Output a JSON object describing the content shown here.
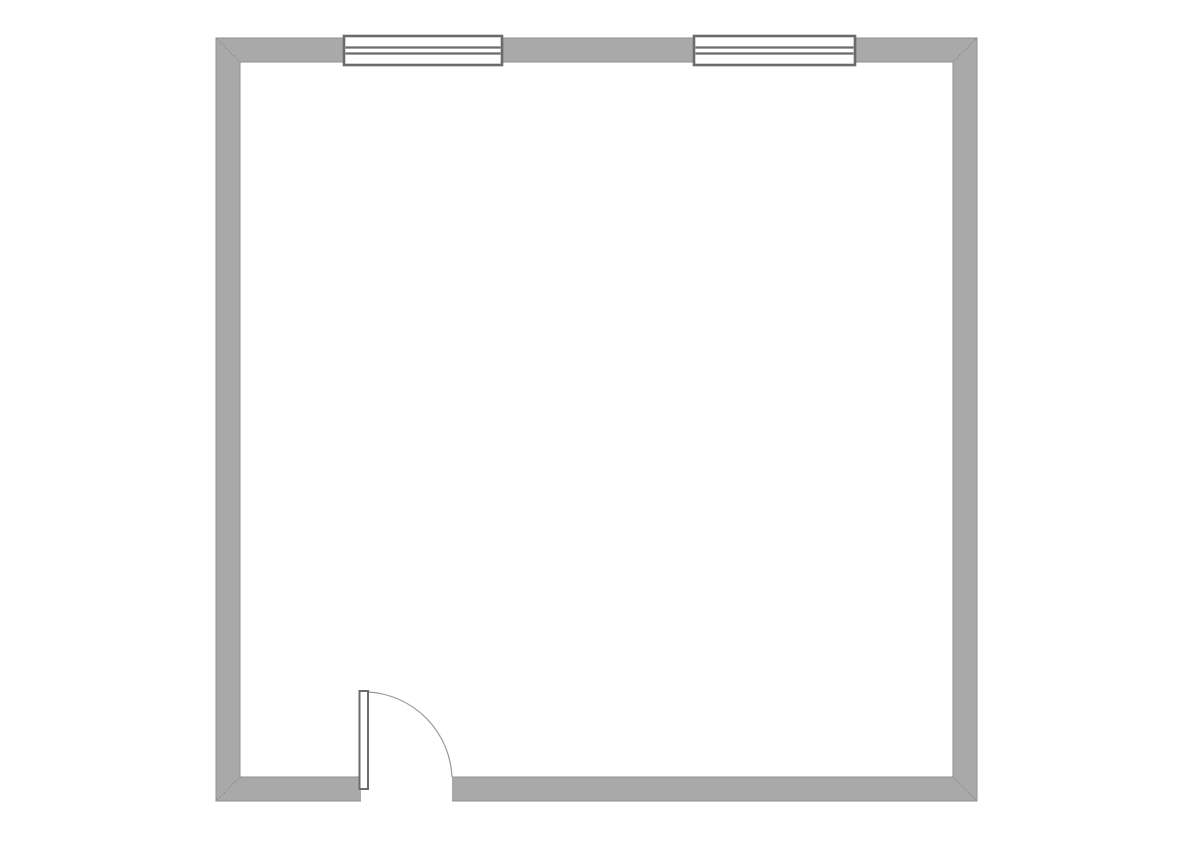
{
  "document": {
    "type": "architectural-floor-plan",
    "canvas": {
      "width": 1190,
      "height": 841,
      "background": "#ffffff"
    }
  },
  "palette": {
    "wall_fill": "#a9a9a9",
    "wall_edge": "#8f8f8f",
    "symbol_stroke": "#6b6b6b",
    "miter_line": "#8a8a8a",
    "swing_arc": "#9a9a9a",
    "opening_fill": "#ffffff"
  },
  "room": {
    "outer": {
      "x": 216,
      "y": 38,
      "width": 761,
      "height": 763
    },
    "wall_thickness": 24,
    "corner_miters": [
      "top-left",
      "top-right",
      "bottom-left",
      "bottom-right"
    ]
  },
  "windows": [
    {
      "id": "window-1",
      "wall": "top",
      "x": 344,
      "y": 36,
      "width": 158,
      "height": 29,
      "pane_line_offsets": [
        11.5,
        17.5
      ]
    },
    {
      "id": "window-2",
      "wall": "top",
      "x": 694,
      "y": 36,
      "width": 161,
      "height": 29,
      "pane_line_offsets": [
        11.5,
        17.5
      ]
    }
  ],
  "door": {
    "id": "door-1",
    "wall": "bottom",
    "opening": {
      "x": 361,
      "width": 91
    },
    "leaf": {
      "x": 359.5,
      "y": 691,
      "width": 8.5,
      "height": 98
    },
    "swing": {
      "start_x": 368,
      "start_y": 692,
      "end_x": 452,
      "end_y": 777,
      "radius": 89
    }
  }
}
